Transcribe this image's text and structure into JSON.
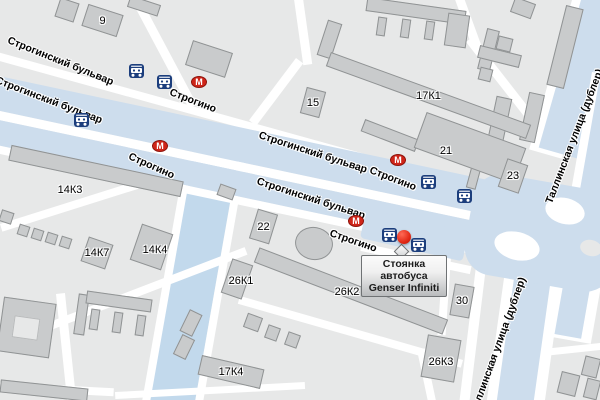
{
  "map": {
    "colors": {
      "background": "#e7e8e8",
      "building": "#c9cbcc",
      "building_border": "#909394",
      "road": "#ffffff",
      "avenue": "#cddded",
      "water": "#c2d9ec",
      "metro_red": "#cf2519",
      "bus_blue": "#1c3e7d",
      "marker_red": "#e22a17"
    },
    "street_labels": [
      {
        "text": "Строгинский бульвар",
        "x": 8,
        "y": 40,
        "r": 22
      },
      {
        "text": "Строгинский бульвар",
        "x": -4,
        "y": 80,
        "r": 21
      },
      {
        "text": "Строгинский бульвар",
        "x": 259,
        "y": 135,
        "r": 18
      },
      {
        "text": "Строгинский бульвар",
        "x": 257,
        "y": 181,
        "r": 18
      },
      {
        "text": "Таллинская улица (дублер)",
        "x": 549,
        "y": 203,
        "r": -69
      },
      {
        "text": "Таллинская улица (дублер)",
        "x": 474,
        "y": 412,
        "r": -70
      }
    ],
    "metro_letter": "М",
    "metro_stations": [
      {
        "name": "Строгино",
        "ix": 191,
        "iy": 76,
        "lx": 170,
        "ly": 92,
        "r": 21
      },
      {
        "name": "Строгино",
        "ix": 152,
        "iy": 140,
        "lx": 129,
        "ly": 156,
        "r": 24
      },
      {
        "name": "Строгино",
        "ix": 390,
        "iy": 154,
        "lx": 370,
        "ly": 170,
        "r": 21
      },
      {
        "name": "Строгино",
        "ix": 348,
        "iy": 215,
        "lx": 330,
        "ly": 233,
        "r": 19
      }
    ],
    "bus_stops": [
      {
        "x": 129,
        "y": 64
      },
      {
        "x": 157,
        "y": 75
      },
      {
        "x": 74,
        "y": 113
      },
      {
        "x": 421,
        "y": 175
      },
      {
        "x": 457,
        "y": 189
      },
      {
        "x": 382,
        "y": 228
      },
      {
        "x": 411,
        "y": 238
      }
    ],
    "buildings": [
      {
        "label": "9",
        "x": 84,
        "y": 9,
        "w": 37,
        "h": 23,
        "r": 18
      },
      {
        "label": "15",
        "x": 303,
        "y": 89,
        "w": 20,
        "h": 27,
        "r": 15
      },
      {
        "label": "17К1",
        "x": 322,
        "y": 88,
        "w": 213,
        "h": 15,
        "r": 20
      },
      {
        "label": "21",
        "x": 417,
        "y": 129,
        "w": 106,
        "h": 38,
        "r": 20,
        "lx": 446,
        "ly": 151
      },
      {
        "label": "23",
        "x": 502,
        "y": 161,
        "w": 22,
        "h": 30,
        "r": 19
      },
      {
        "label": "14К3",
        "x": 8,
        "y": 163,
        "w": 176,
        "h": 16,
        "r": 12,
        "lx": 70,
        "ly": 190
      },
      {
        "label": "14К4",
        "x": 135,
        "y": 228,
        "w": 33,
        "h": 38,
        "r": 19,
        "lx": 155,
        "ly": 250
      },
      {
        "label": "14К7",
        "x": 84,
        "y": 240,
        "w": 26,
        "h": 26,
        "r": 19
      },
      {
        "label": "22",
        "x": 253,
        "y": 211,
        "w": 21,
        "h": 31,
        "r": 17
      },
      {
        "label": "26К1",
        "x": 226,
        "y": 261,
        "w": 22,
        "h": 36,
        "r": 19,
        "lx": 241,
        "ly": 281
      },
      {
        "label": "26К2",
        "x": 250,
        "y": 283,
        "w": 202,
        "h": 16,
        "r": 21,
        "lx": 347,
        "ly": 292
      },
      {
        "label": "30",
        "x": 452,
        "y": 285,
        "w": 20,
        "h": 32,
        "r": 10
      },
      {
        "label": "26К3",
        "x": 424,
        "y": 337,
        "w": 34,
        "h": 43,
        "r": 10,
        "lx": 441,
        "ly": 362
      },
      {
        "label": "17К4",
        "x": 199,
        "y": 362,
        "w": 64,
        "h": 20,
        "r": 13
      }
    ],
    "marker": {
      "x": 397,
      "y": 230
    },
    "callout": {
      "x": 361,
      "y": 255,
      "line1": "Стоянка автобуса",
      "line2": "Genser Infiniti"
    }
  }
}
